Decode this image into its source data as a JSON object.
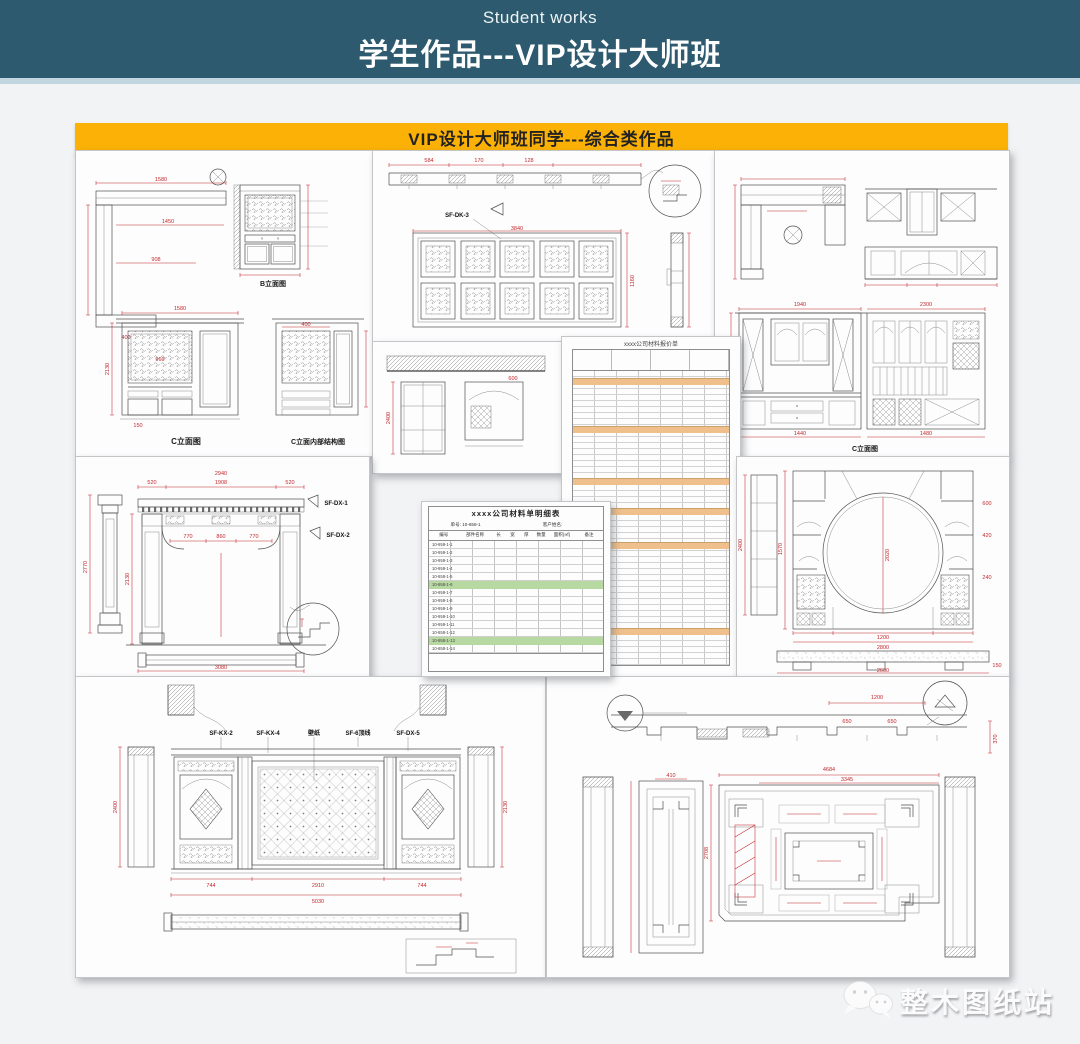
{
  "header": {
    "subtitle": "Student works",
    "title": "学生作品---VIP设计大师班"
  },
  "banner": {
    "title": "VIP设计大师班同学---综合类作品"
  },
  "colors": {
    "header_bg": "#2d5a6e",
    "header_accent": "#c2d6e0",
    "banner_bg": "#fbb105",
    "page_bg": "#f2f3f5",
    "dim_red": "#c3272b",
    "cad_line": "#4f4f4f",
    "table_orange": "#f0c08c",
    "table_green": "#b8d8a2"
  },
  "watermark": {
    "label": "整木图纸站",
    "icon": "wechat-icon"
  },
  "panels": {
    "top_left": {
      "caption_b": "B立面图",
      "caption_c": "C立面图",
      "caption_ci": "C立面内部结构图",
      "dims": [
        "1580",
        "1450",
        "908",
        "400",
        "1580",
        "2130",
        "960",
        "150"
      ]
    },
    "top_middle": {
      "label": "SF-DK-3",
      "dims": [
        "3840",
        "584",
        "170",
        "128",
        "1160"
      ]
    },
    "top_right": {
      "caption": "C立面图",
      "dims": [
        "1940",
        "2300",
        "2710",
        "1440",
        "1480"
      ]
    },
    "portal": {
      "label_1": "SF-DX-1",
      "label_2": "SF-DX-2",
      "dims": [
        "2940",
        "520",
        "1908",
        "520",
        "2770",
        "2130",
        "770",
        "860",
        "770",
        "3080"
      ]
    },
    "wall_section": {
      "dims": [
        "2400",
        "600"
      ]
    },
    "quote_sheet": {
      "title": "xxxx公司材料报价单"
    },
    "material_table": {
      "title": "xxxx公司材料单明细表",
      "order_no": "单号: 10-658-1",
      "customer": "客户姓名:",
      "headers": [
        "编号",
        "部件名称",
        "长",
        "宽",
        "厚",
        "数量",
        "面积(㎡)",
        "备注"
      ],
      "codes": [
        "10-658-1-1",
        "10-658-1-2",
        "10-658-1-3",
        "10-658-1-4",
        "10-658-1-5",
        "10-658-1-6",
        "10-658-1-7",
        "10-658-1-8",
        "10-658-1-9",
        "10-658-1-10",
        "10-658-1-11",
        "10-658-1-12",
        "10-658-1-13",
        "10-658-1-14"
      ]
    },
    "moon_gate": {
      "dims": [
        "2400",
        "1570",
        "2020",
        "1200",
        "2800",
        "2600",
        "150",
        "600",
        "420",
        "240"
      ]
    },
    "tv_wall": {
      "label_kx2": "SF-KX-2",
      "label_kx4": "SF-KX-4",
      "label_wallpaper": "壁纸",
      "label_top": "SF-6顶线",
      "label_dx": "SF-DX-5",
      "dims": [
        "5030",
        "744",
        "2910",
        "744",
        "2400",
        "2130"
      ]
    },
    "ceiling": {
      "dims": [
        "4684",
        "3345",
        "2708",
        "410",
        "1200",
        "370",
        "650",
        "650"
      ]
    }
  }
}
